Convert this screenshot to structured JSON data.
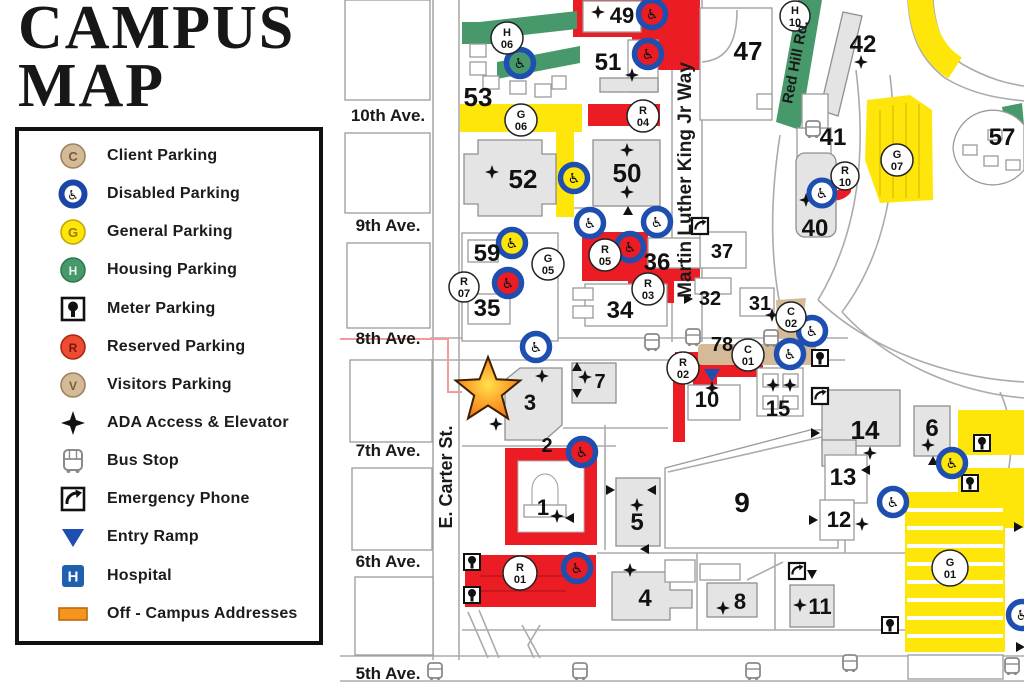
{
  "title": {
    "line1": "CAMPUS",
    "line2": "MAP"
  },
  "legend": {
    "items": [
      {
        "label": "Client Parking",
        "letter": "C",
        "icon": "client-parking-icon"
      },
      {
        "label": "Disabled Parking",
        "icon": "disabled-parking-icon"
      },
      {
        "label": "General Parking",
        "letter": "G",
        "icon": "general-parking-icon"
      },
      {
        "label": "Housing Parking",
        "letter": "H",
        "icon": "housing-parking-icon"
      },
      {
        "label": "Meter Parking",
        "icon": "meter-parking-icon"
      },
      {
        "label": "Reserved Parking",
        "letter": "R",
        "icon": "reserved-parking-icon"
      },
      {
        "label": "Visitors Parking",
        "letter": "V",
        "icon": "visitors-parking-icon"
      },
      {
        "label": "ADA Access & Elevator",
        "icon": "ada-star-icon"
      },
      {
        "label": "Bus Stop",
        "icon": "bus-stop-icon"
      },
      {
        "label": "Emergency Phone",
        "icon": "emergency-phone-icon"
      },
      {
        "label": "Entry Ramp",
        "icon": "entry-ramp-icon"
      },
      {
        "label": "Hospital",
        "letter": "H",
        "icon": "hospital-icon"
      },
      {
        "label": "Off - Campus Addresses",
        "icon": "off-campus-icon"
      }
    ]
  },
  "icons": {
    "wheelchair": "♿",
    "hospital_letter": "H"
  },
  "streets": {
    "ave10": "10th Ave.",
    "ave9": "9th Ave.",
    "ave8": "8th Ave.",
    "ave7": "7th Ave.",
    "ave6": "6th Ave.",
    "ave5": "5th Ave.",
    "carter": "E. Carter St.",
    "mlk": "Martin Luther King Jr Way",
    "redhill": "Red Hill Rd."
  },
  "buildings": {
    "b1": "1",
    "b2": "2",
    "b3": "3",
    "b4": "4",
    "b5": "5",
    "b6": "6",
    "b7": "7",
    "b8": "8",
    "b9": "9",
    "b10": "10",
    "b11": "11",
    "b12": "12",
    "b13": "13",
    "b14": "14",
    "b15": "15",
    "b31": "31",
    "b32": "32",
    "b34": "34",
    "b35": "35",
    "b36": "36",
    "b37": "37",
    "b40": "40",
    "b41": "41",
    "b42": "42",
    "b47": "47",
    "b49": "49",
    "b50": "50",
    "b51": "51",
    "b52": "52",
    "b53": "53",
    "b57": "57",
    "b59": "59",
    "b78": "78"
  },
  "lots": {
    "C01": {
      "letter": "C",
      "num": "01"
    },
    "C02": {
      "letter": "C",
      "num": "02"
    },
    "G01": {
      "letter": "G",
      "num": "01"
    },
    "G05": {
      "letter": "G",
      "num": "05"
    },
    "G06": {
      "letter": "G",
      "num": "06"
    },
    "G07": {
      "letter": "G",
      "num": "07"
    },
    "H06": {
      "letter": "H",
      "num": "06"
    },
    "H10": {
      "letter": "H",
      "num": "10"
    },
    "R01": {
      "letter": "R",
      "num": "01"
    },
    "R02": {
      "letter": "R",
      "num": "02"
    },
    "R03": {
      "letter": "R",
      "num": "03"
    },
    "R04": {
      "letter": "R",
      "num": "04"
    },
    "R05": {
      "letter": "R",
      "num": "05"
    },
    "R07": {
      "letter": "R",
      "num": "07"
    },
    "R10": {
      "letter": "R",
      "num": "10"
    }
  },
  "colors": {
    "reserved_red": "#EC1C24",
    "general_yellow": "#FFE60A",
    "housing_green": "#47996B",
    "client_tan": "#D4BA97",
    "disabled_blue": "#1E4FB0",
    "hospital_blue": "#1E5FAF",
    "off_campus_orange": "#F7941D",
    "building_gray": "#E4E4E4",
    "star_orange": "#F47B20"
  }
}
